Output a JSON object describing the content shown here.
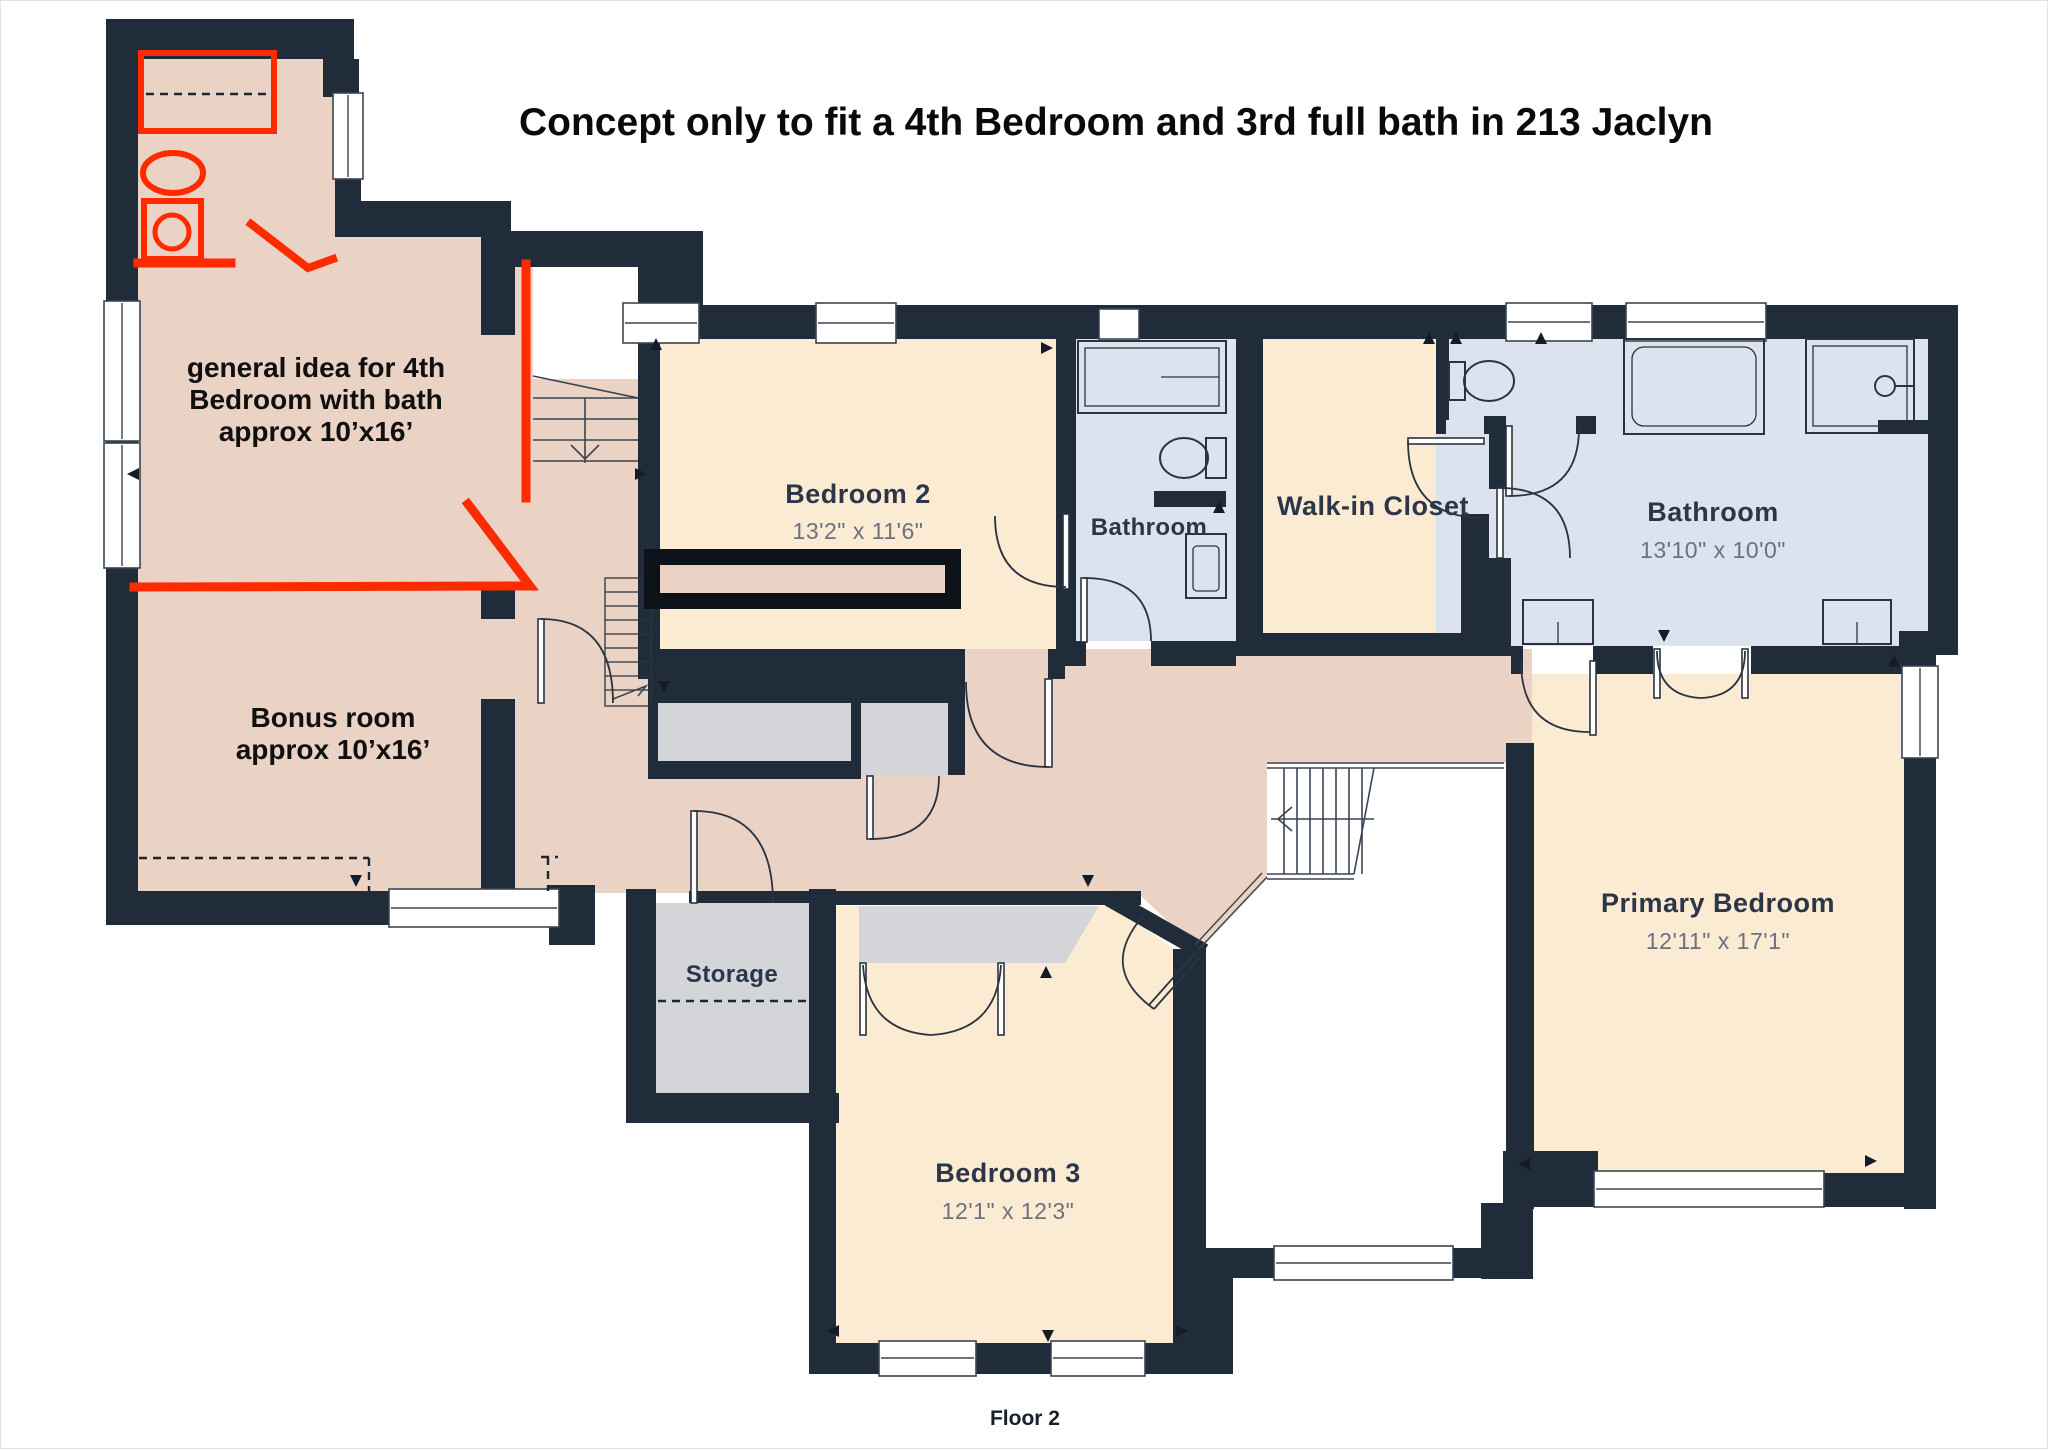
{
  "title": "Concept only to fit a 4th Bedroom and 3rd full bath in 213 Jaclyn",
  "footer": {
    "floor_label": "Floor 2"
  },
  "concept_notes": {
    "bedroom4": {
      "line1": "general idea for 4th",
      "line2": "Bedroom with bath",
      "line3": "approx 10’x16’"
    },
    "bonus_room": {
      "line1": "Bonus room",
      "line2": "approx 10’x16’"
    }
  },
  "rooms": {
    "bedroom2": {
      "name": "Bedroom 2",
      "dims": "13'2\" x 11'6\""
    },
    "hall_bathroom": {
      "name": "Bathroom"
    },
    "walk_in_closet": {
      "name": "Walk-in Closet"
    },
    "primary_bathroom": {
      "name": "Bathroom",
      "dims": "13'10\" x 10'0\""
    },
    "primary_bedroom": {
      "name": "Primary Bedroom",
      "dims": "12'11\" x 17'1\""
    },
    "storage": {
      "name": "Storage"
    },
    "bedroom3": {
      "name": "Bedroom 3",
      "dims": "12'1\" x 12'3\""
    }
  },
  "colors": {
    "wall": "#212c3a",
    "peach": "#fcebd3",
    "tan": "#ead2c4",
    "blue": "#dde3ee",
    "gray": "#d3d5d9",
    "red": "#ff2b00",
    "ink": "#2b3648",
    "dim": "#6a7280",
    "bar": "#0d1219"
  }
}
